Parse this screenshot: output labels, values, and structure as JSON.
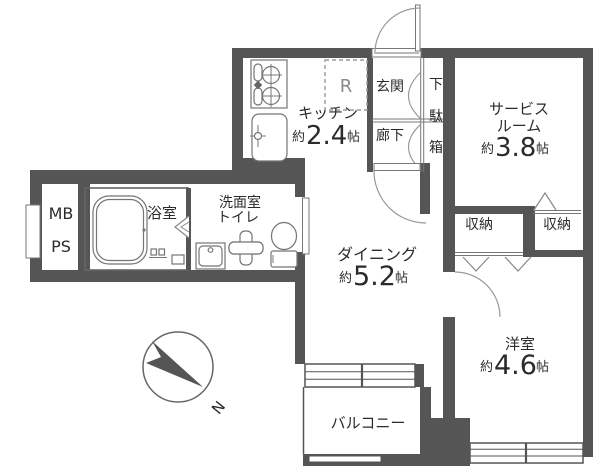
{
  "plan": {
    "rooms": {
      "kitchen": {
        "label": "キッチン",
        "approx": "約",
        "size": "2.4",
        "unit": "帖"
      },
      "service_room": {
        "label_line1": "サービス",
        "label_line2": "ルーム",
        "approx": "約",
        "size": "3.8",
        "unit": "帖"
      },
      "dining": {
        "label": "ダイニング",
        "approx": "約",
        "size": "5.2",
        "unit": "帖"
      },
      "western_room": {
        "label": "洋室",
        "approx": "約",
        "size": "4.6",
        "unit": "帖"
      },
      "balcony": {
        "label": "バルコニー"
      },
      "bath": {
        "label": "浴室"
      },
      "washroom": {
        "label_line1": "洗面室",
        "label_line2": "トイレ"
      },
      "entrance": {
        "label": "玄関"
      },
      "hallway": {
        "label": "廊下"
      },
      "shoe_cabinet": {
        "char1": "下",
        "char2": "駄",
        "char3": "箱"
      },
      "storage_left": {
        "label": "収納"
      },
      "storage_right": {
        "label": "収納"
      },
      "meter_box": {
        "label": "MB"
      },
      "pipe_space": {
        "label": "PS"
      }
    },
    "symbols": {
      "refrigerator": "R",
      "compass_north": "N"
    },
    "colors": {
      "wall": "#555555",
      "thin_line": "#777777",
      "arc_line": "#999999",
      "text": "#2b2b2b",
      "background": "#ffffff"
    }
  }
}
